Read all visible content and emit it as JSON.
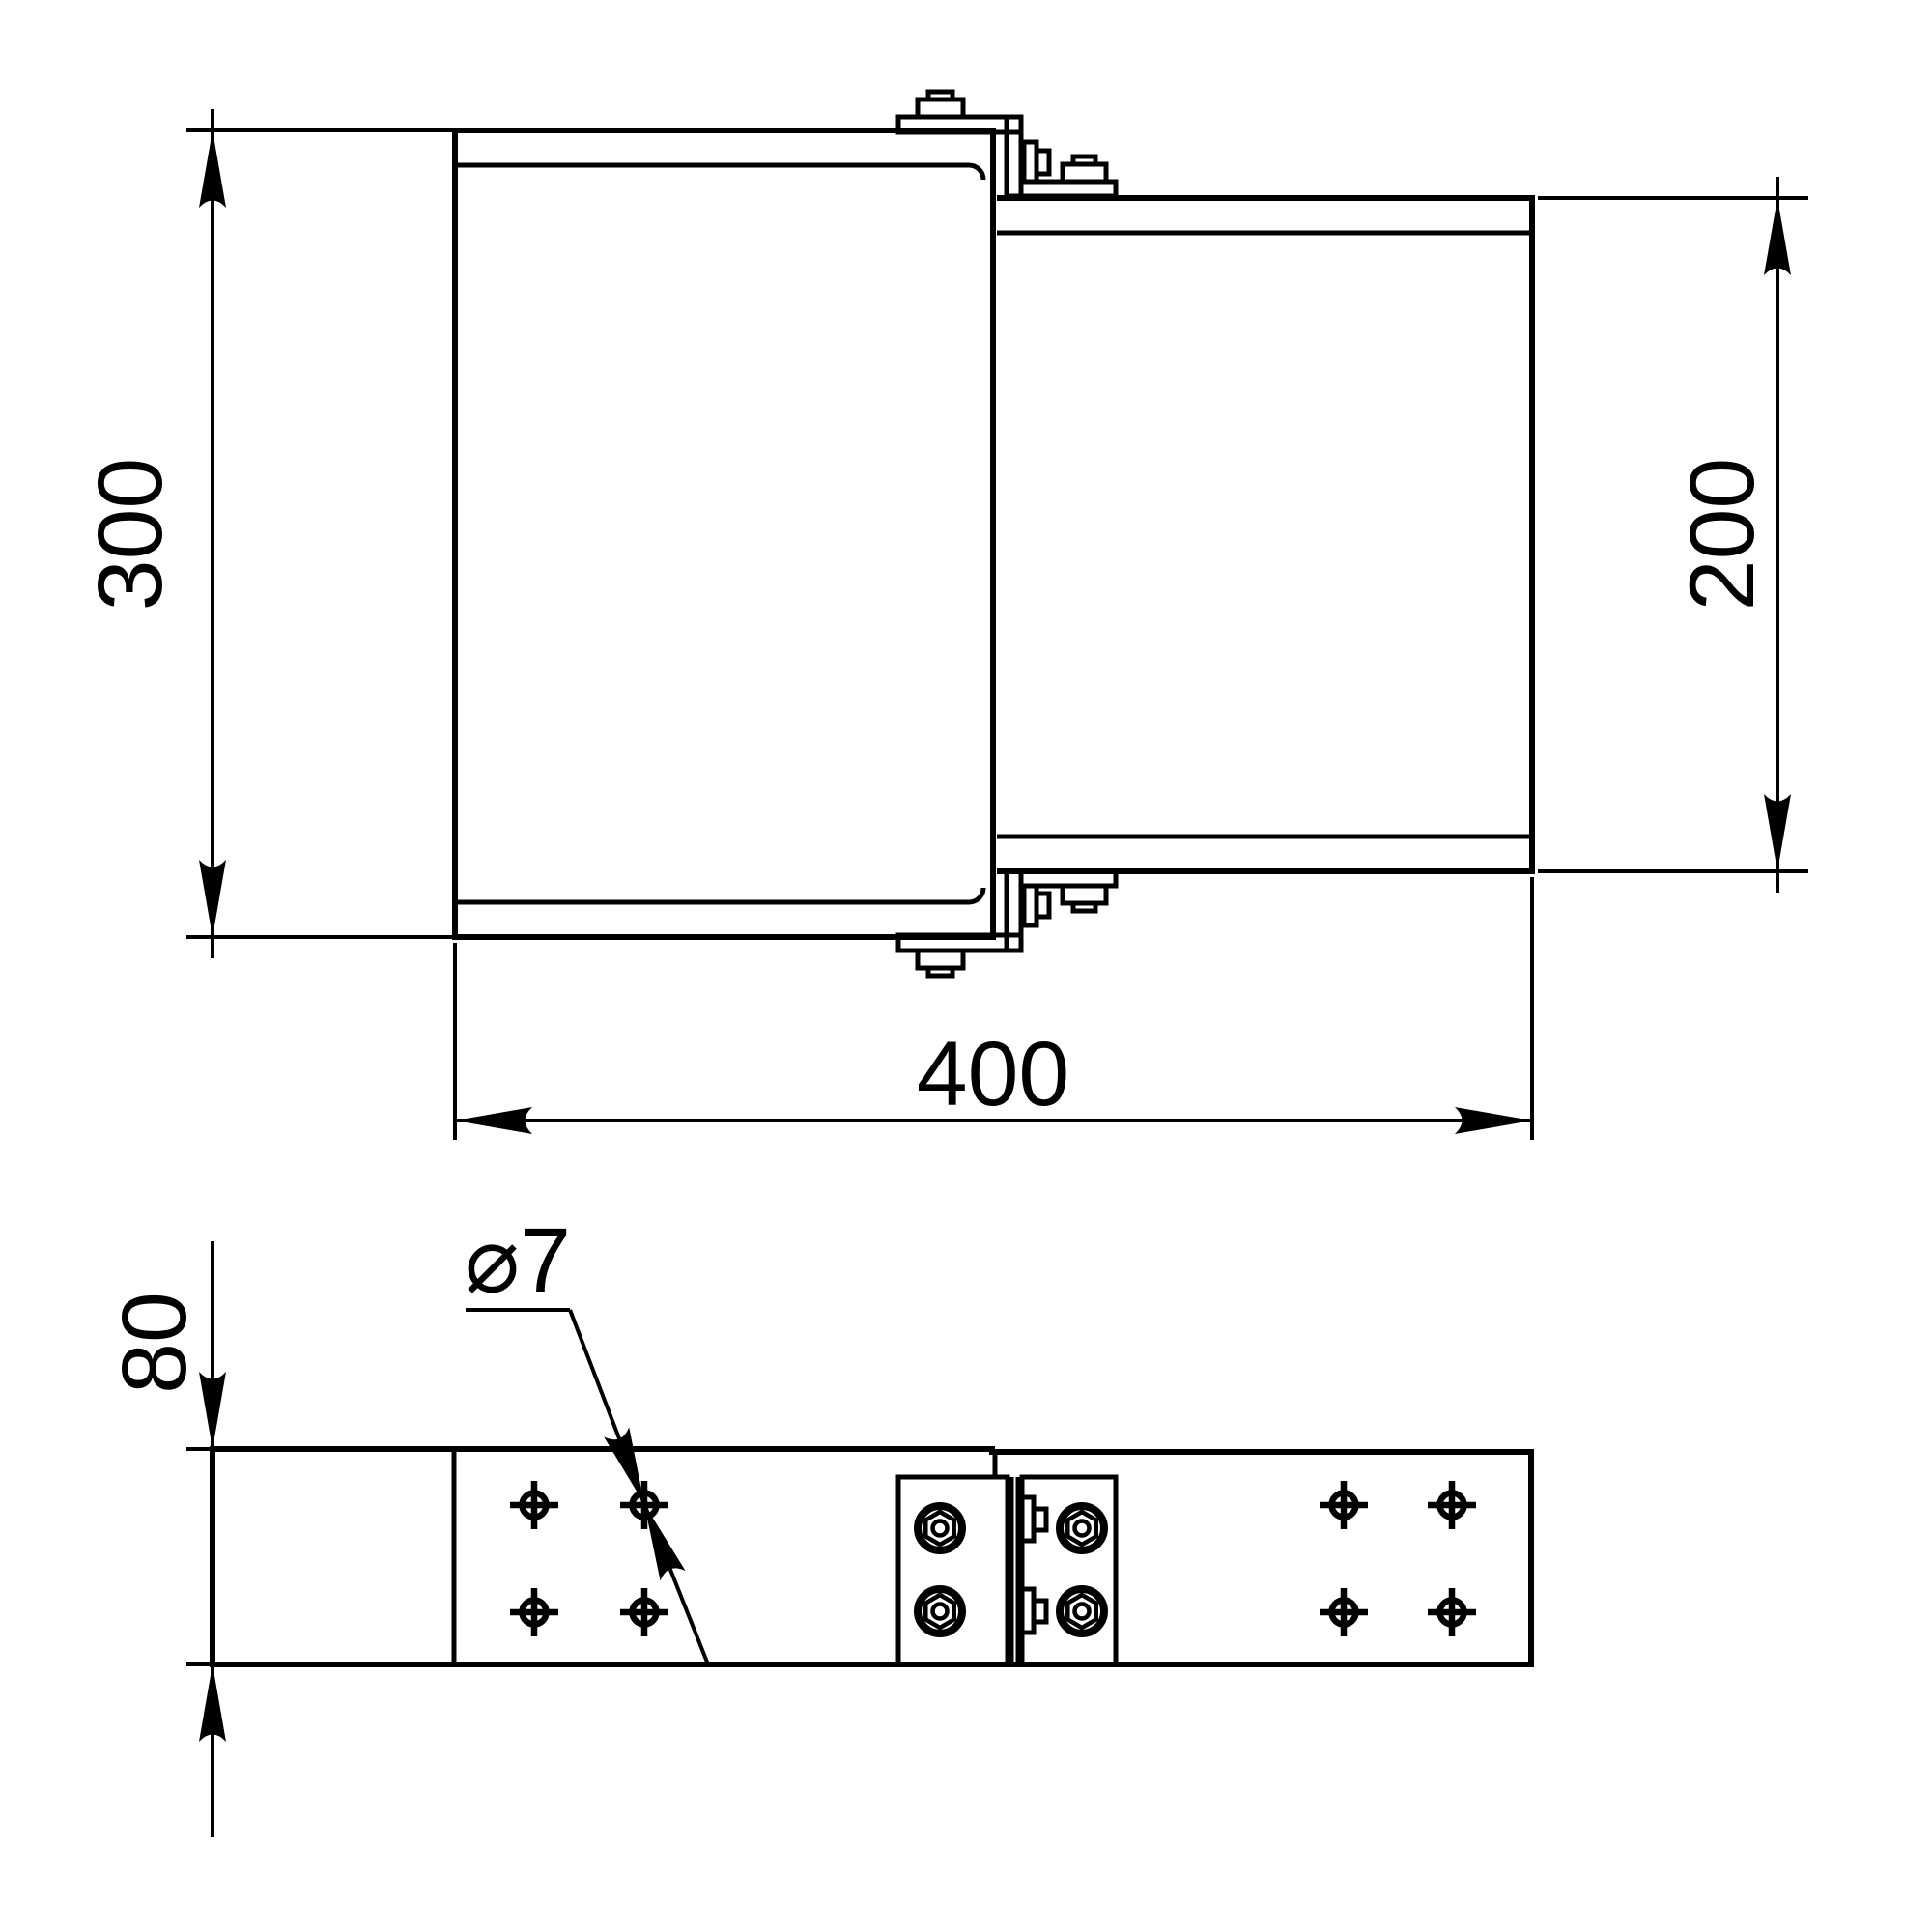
{
  "drawing": {
    "background": "#ffffff",
    "line_color": "#000000"
  },
  "labels": {
    "dim_left_height": "300",
    "dim_right_height": "200",
    "dim_overall_length": "400",
    "dim_strip_depth": "80",
    "hole_callout": "⌀7"
  }
}
